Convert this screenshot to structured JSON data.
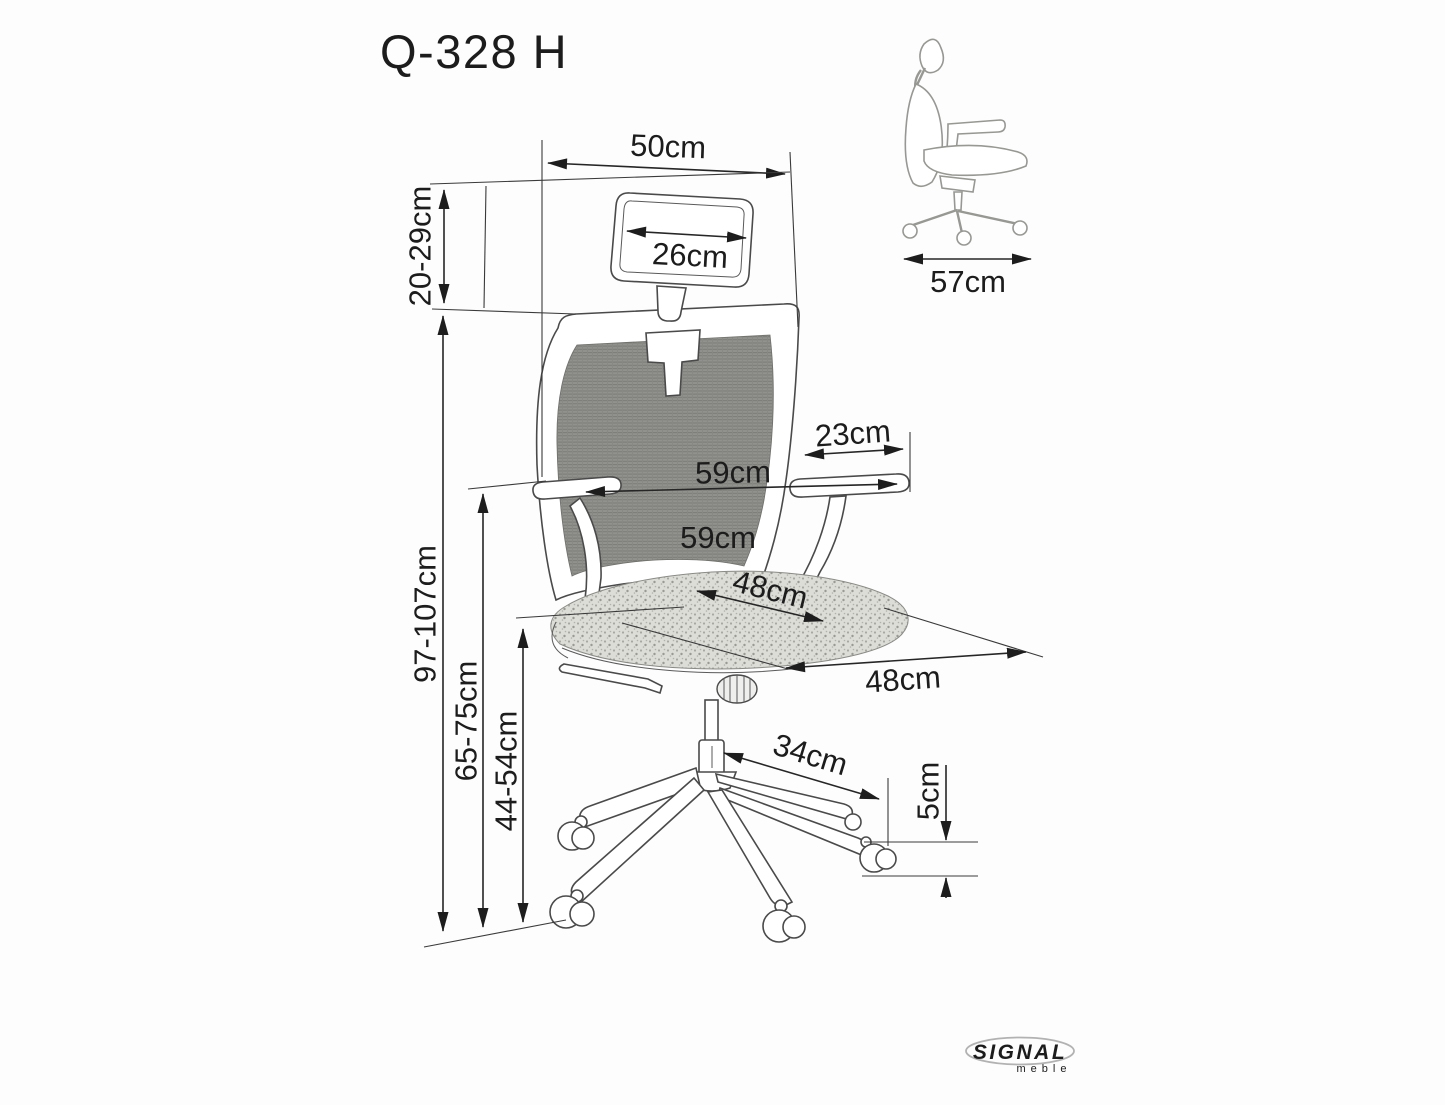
{
  "title": "Q-328 H",
  "front_view_dims": {
    "headrest_outer_width": "50cm",
    "headrest_pad_width": "26cm",
    "headrest_height_adjust": "20-29cm",
    "total_height": "97-107cm",
    "armrest_height": "65-75cm",
    "seat_height": "44-54cm",
    "armrest_pad_length": "23cm",
    "overall_width": "59cm",
    "backrest_width": "59cm",
    "seat_depth": "48cm",
    "seat_width": "48cm",
    "base_leg_reach": "34cm",
    "caster_height": "5cm"
  },
  "side_view_dims": {
    "overall_depth": "57cm"
  },
  "brand": {
    "logo": "SIGNAL",
    "tagline": "meble"
  }
}
